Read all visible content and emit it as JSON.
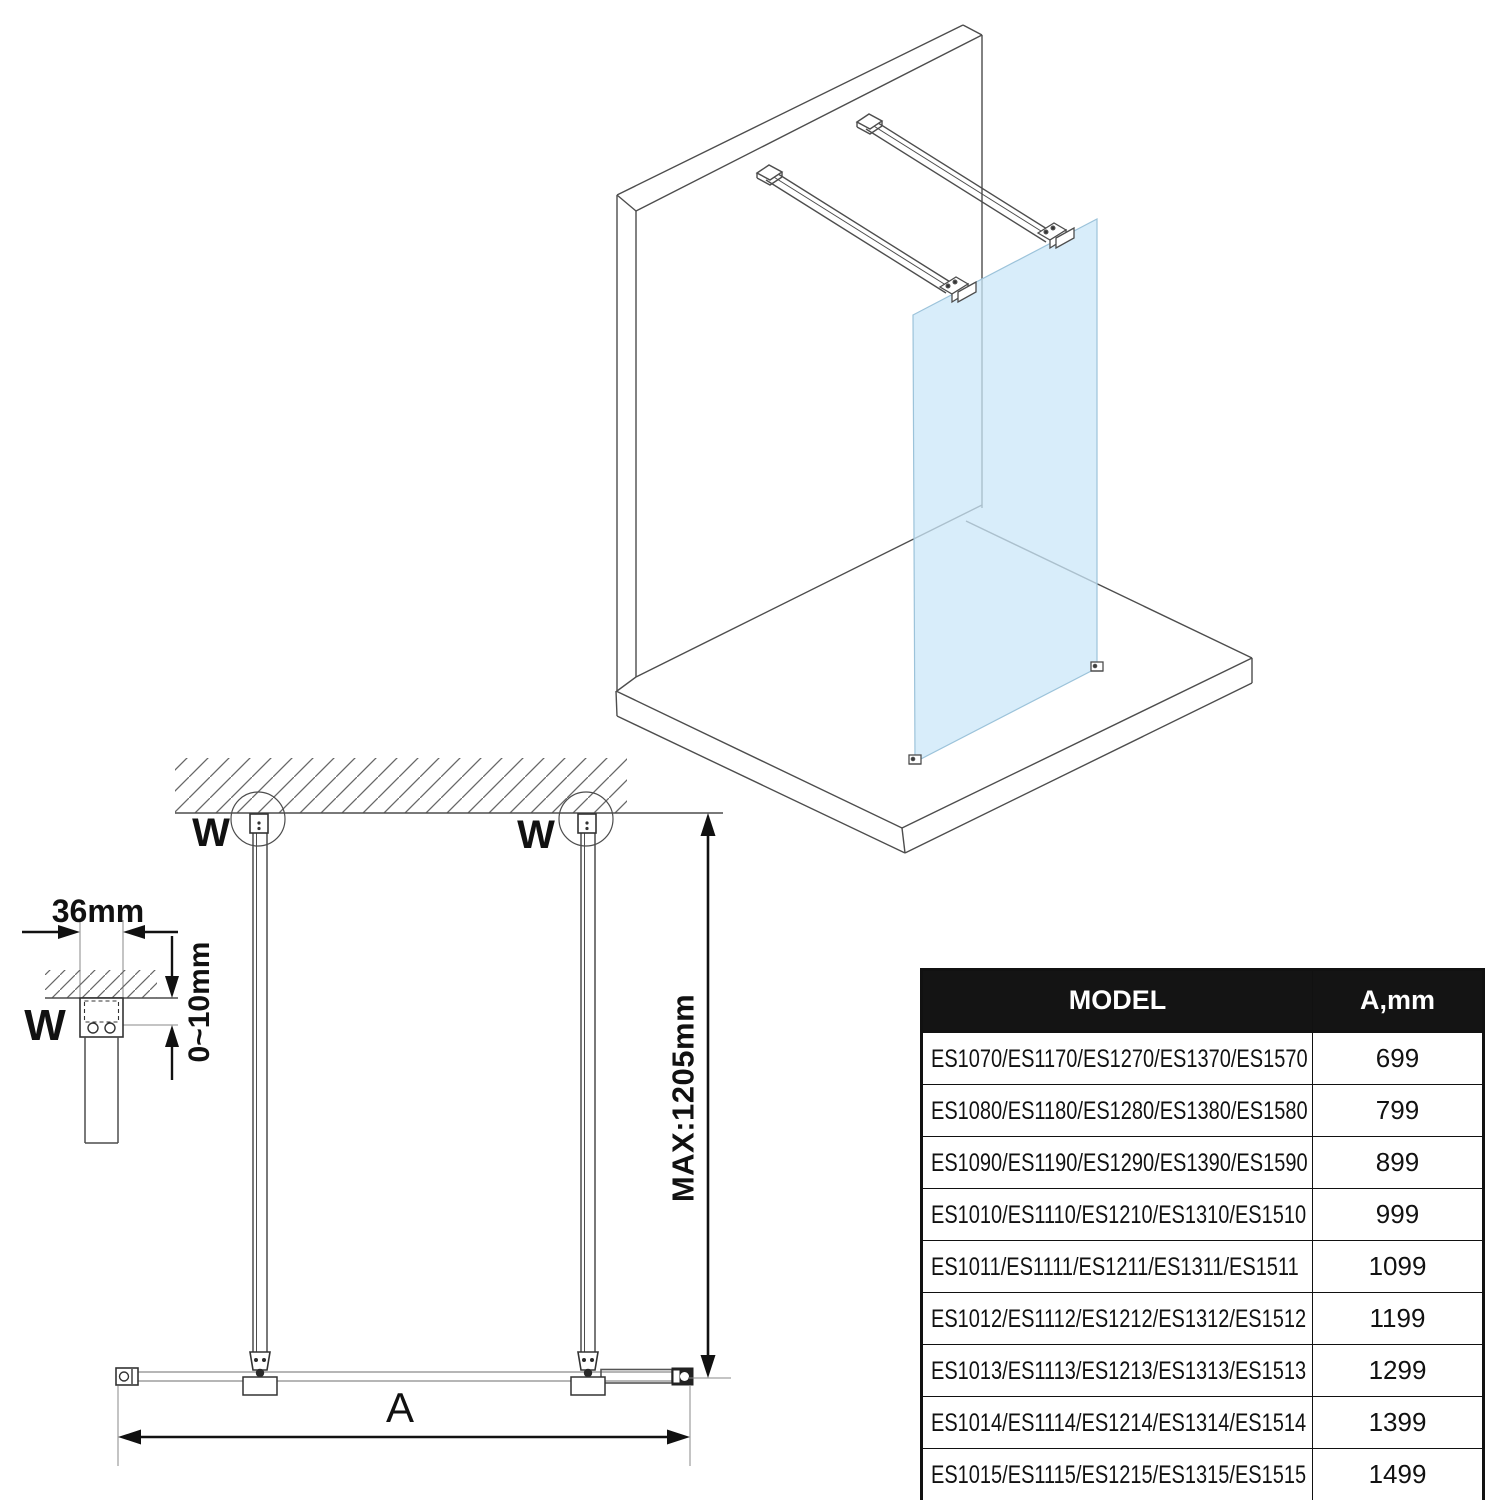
{
  "labels": {
    "wall_marker": "W",
    "bracket_width": "36mm",
    "ceiling_gap": "0~10mm",
    "max_height": "MAX:1205mm",
    "width_dim": "A"
  },
  "colors": {
    "glass": "#cbe7f8",
    "line": "#4d4d4d",
    "dimension": "#111111",
    "table_header_bg": "#141414",
    "table_header_text": "#ffffff"
  },
  "table": {
    "headers": {
      "model": "MODEL",
      "a_mm": "A,mm"
    },
    "rows": [
      {
        "models": "ES1070/ES1170/ES1270/ES1370/ES1570",
        "a": "699"
      },
      {
        "models": "ES1080/ES1180/ES1280/ES1380/ES1580",
        "a": "799"
      },
      {
        "models": "ES1090/ES1190/ES1290/ES1390/ES1590",
        "a": "899"
      },
      {
        "models": "ES1010/ES1110/ES1210/ES1310/ES1510",
        "a": "999"
      },
      {
        "models": "ES1011/ES1111/ES1211/ES1311/ES1511",
        "a": "1099"
      },
      {
        "models": "ES1012/ES1112/ES1212/ES1312/ES1512",
        "a": "1199"
      },
      {
        "models": "ES1013/ES1113/ES1213/ES1313/ES1513",
        "a": "1299"
      },
      {
        "models": "ES1014/ES1114/ES1214/ES1314/ES1514",
        "a": "1399"
      },
      {
        "models": "ES1015/ES1115/ES1215/ES1315/ES1515",
        "a": "1499"
      }
    ]
  }
}
